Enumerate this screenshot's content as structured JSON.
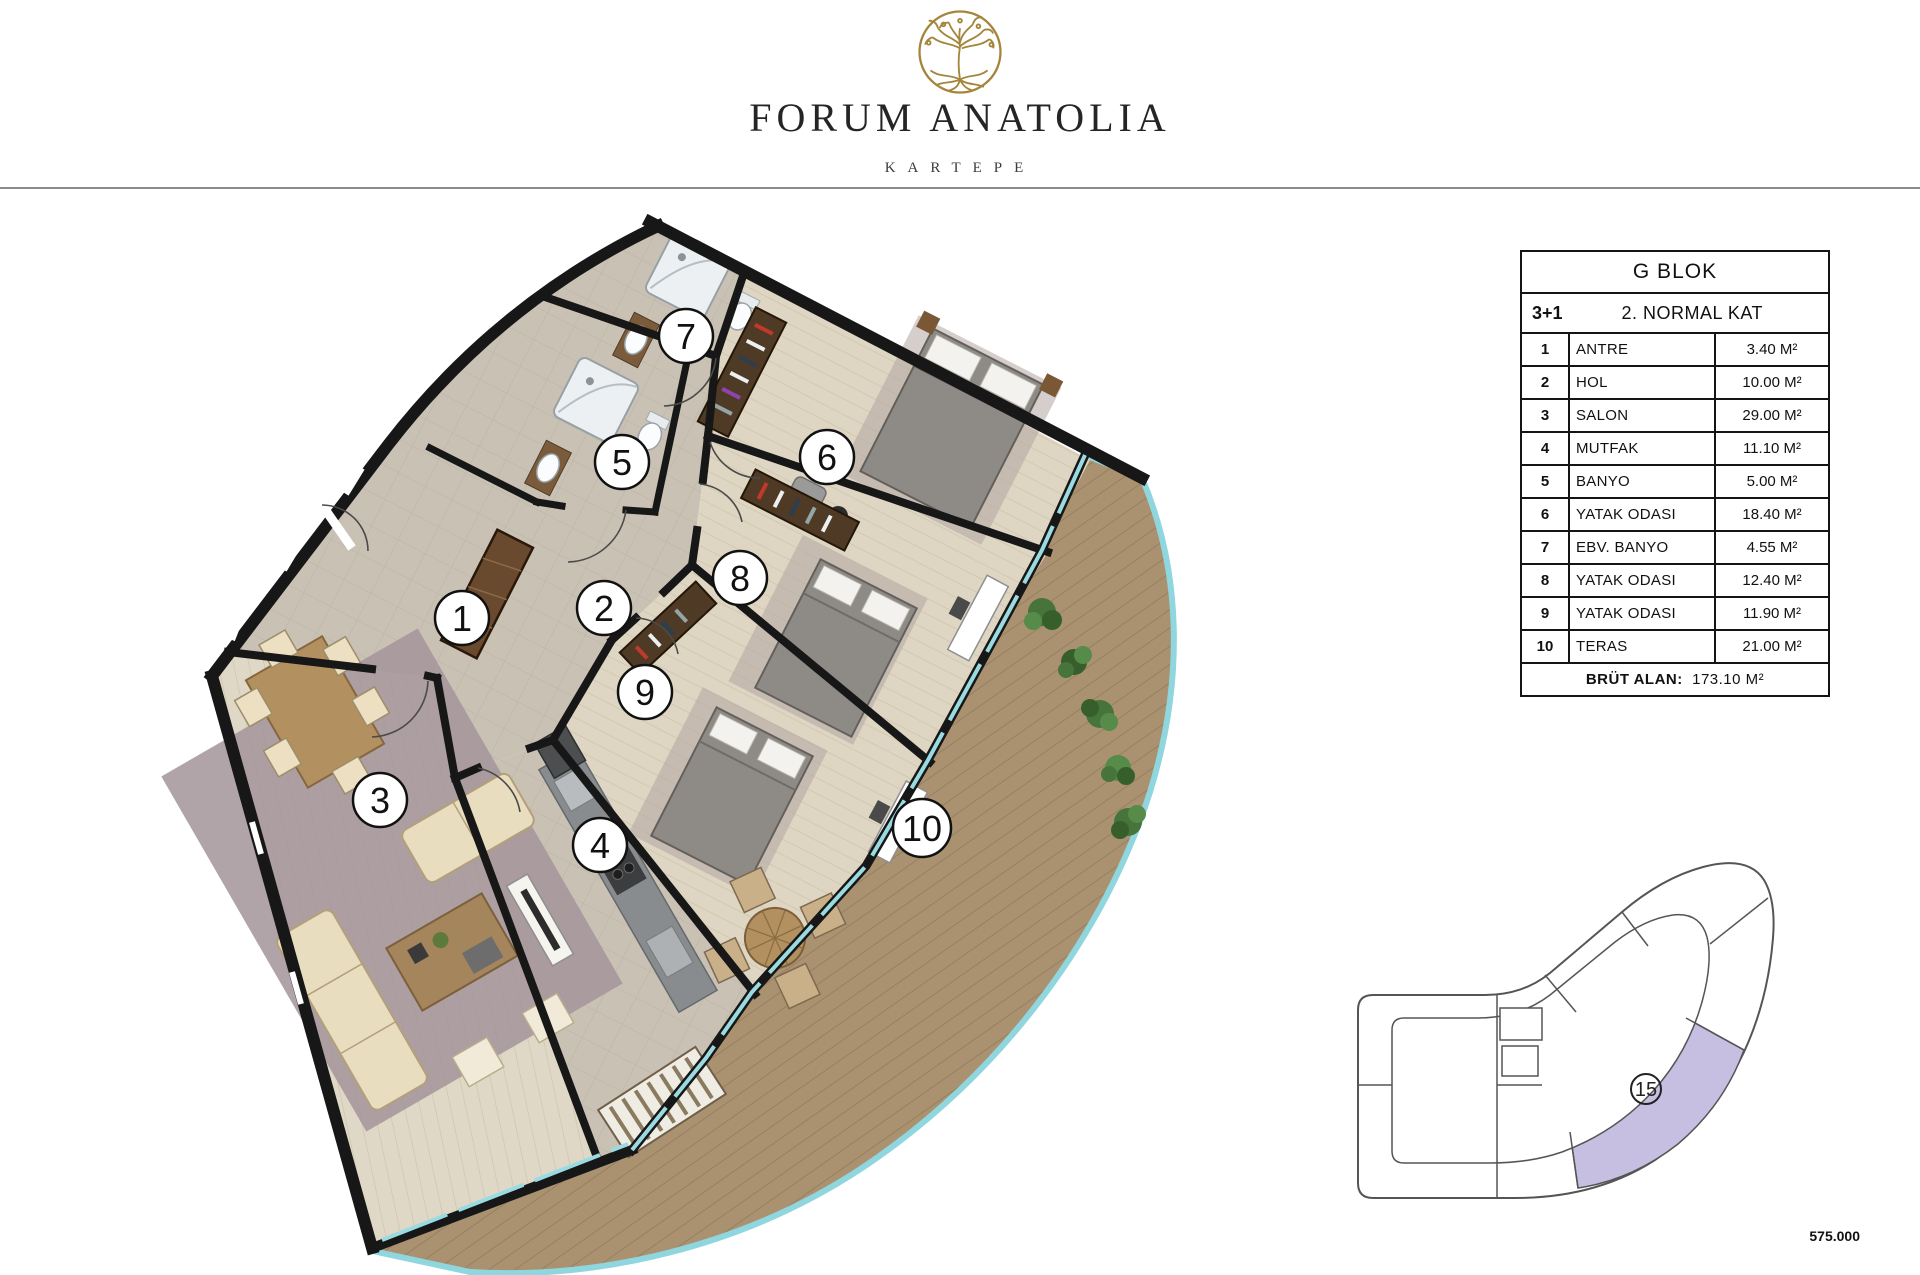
{
  "brand": {
    "title": "FORUM ANATOLIA",
    "subtitle": "KARTEPE",
    "logo_color": "#a4863b"
  },
  "info_table": {
    "title": "G BLOK",
    "unit_type": "3+1",
    "floor": "2. NORMAL KAT",
    "rows": [
      {
        "num": "1",
        "name": "ANTRE",
        "area": "3.40 M²"
      },
      {
        "num": "2",
        "name": "HOL",
        "area": "10.00 M²"
      },
      {
        "num": "3",
        "name": "SALON",
        "area": "29.00 M²"
      },
      {
        "num": "4",
        "name": "MUTFAK",
        "area": "11.10 M²"
      },
      {
        "num": "5",
        "name": "BANYO",
        "area": "5.00 M²"
      },
      {
        "num": "6",
        "name": "YATAK ODASI",
        "area": "18.40 M²"
      },
      {
        "num": "7",
        "name": "EBV. BANYO",
        "area": "4.55 M²"
      },
      {
        "num": "8",
        "name": "YATAK ODASI",
        "area": "12.40 M²"
      },
      {
        "num": "9",
        "name": "YATAK ODASI",
        "area": "11.90 M²"
      },
      {
        "num": "10",
        "name": "TERAS",
        "area": "21.00 M²"
      }
    ],
    "total_label": "BRÜT ALAN:",
    "total_value": "173.10 M²"
  },
  "plan": {
    "rooms": [
      {
        "num": "1"
      },
      {
        "num": "2"
      },
      {
        "num": "3"
      },
      {
        "num": "4"
      },
      {
        "num": "5"
      },
      {
        "num": "6"
      },
      {
        "num": "7"
      },
      {
        "num": "8"
      },
      {
        "num": "9"
      },
      {
        "num": "10"
      }
    ]
  },
  "key_plan": {
    "unit_number": "15",
    "highlight_color": "#c7bfe2"
  },
  "price": "575.000",
  "colors": {
    "wall": "#171717",
    "tile_floor": "#c9c1b4",
    "wood_floor": "#ded6c3",
    "deck": "#aa9271",
    "rail_glass": "#8fd6de",
    "logo_gold": "#a4863b",
    "highlight": "#c7bfe2"
  }
}
